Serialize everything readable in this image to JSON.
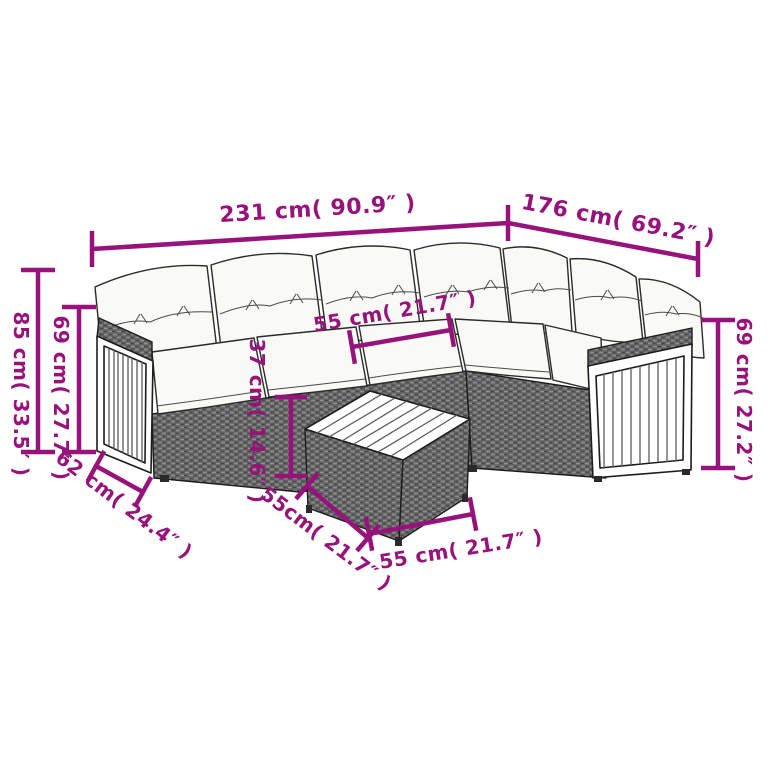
{
  "accent_color": "#97127b",
  "illustration": {
    "subject": "rattan-corner-sofa-set-with-cushions-and-square-coffee-table",
    "back_cushion_count": 7,
    "seat_cushion_count": 5,
    "pieces": "L-shaped modular sofa with wooden slat arm panels and a woven coffee table"
  },
  "dimensions": {
    "sofa_length_left": {
      "label": "231 cm( 90.9″ )"
    },
    "sofa_length_right": {
      "label": "176 cm( 69.2″ )"
    },
    "total_height": {
      "label": "85 cm( 33.5″ )"
    },
    "left_height": {
      "label": "69 cm( 27.7″ )"
    },
    "seat_depth": {
      "label": "62 cm( 24.4″ )"
    },
    "seat_width": {
      "label": "55 cm( 21.7″ )"
    },
    "table_height": {
      "label": "37 cm( 14.6″ )"
    },
    "table_depth": {
      "label": "55cm( 21.7″ )"
    },
    "table_width": {
      "label": "55 cm( 21.7″ )"
    },
    "right_height": {
      "label": "69 cm( 27.2″ )"
    }
  }
}
